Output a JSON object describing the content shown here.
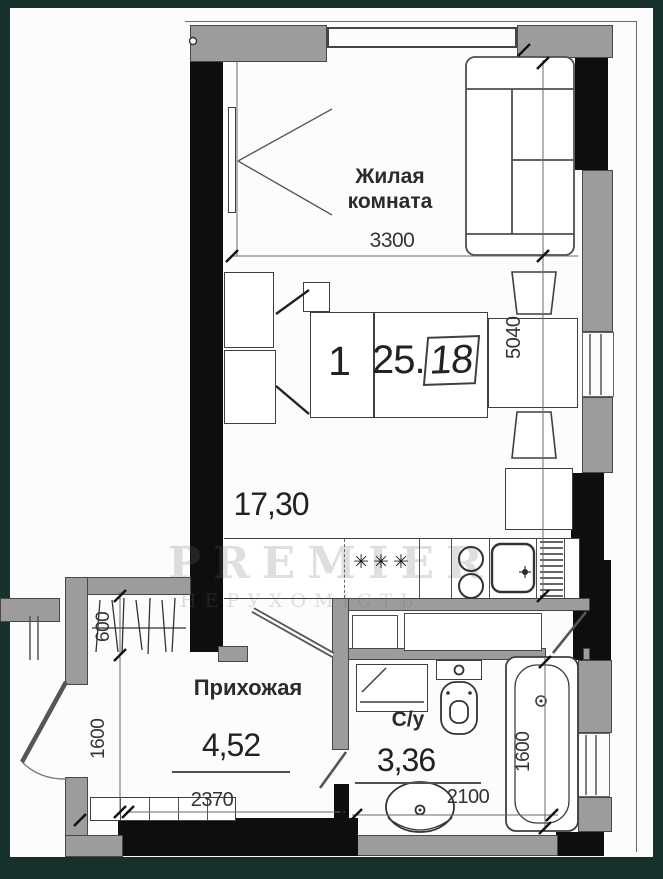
{
  "colors": {
    "frame": "#16302c",
    "page": "#fcfcfc",
    "wall_black": "#0e0e0e",
    "wall_gray": "#9c9c9c",
    "line": "#4f4f4f",
    "text": "#2b2b2b",
    "watermark": "rgba(110,110,110,0.22)"
  },
  "plan": {
    "stamp": {
      "rooms": "1",
      "area_main": "25.",
      "area_frac": "18"
    },
    "living": {
      "label_line1": "Жилая",
      "label_line2": "комната",
      "width_dim": "3300",
      "height_dim": "5040",
      "area": "17,30",
      "hob_symbol": "✳✳✳"
    },
    "hallway": {
      "label": "Прихожая",
      "area": "4,52",
      "closet_dim": "600",
      "side_dim": "1600",
      "width_dim": "2370"
    },
    "bathroom": {
      "label": "С/у",
      "area": "3,36",
      "width_dim": "2100",
      "tub_dim": "1600"
    },
    "watermark": {
      "line1": "PREMIER",
      "line2": "НЕРУХОМІСТЬ"
    }
  }
}
